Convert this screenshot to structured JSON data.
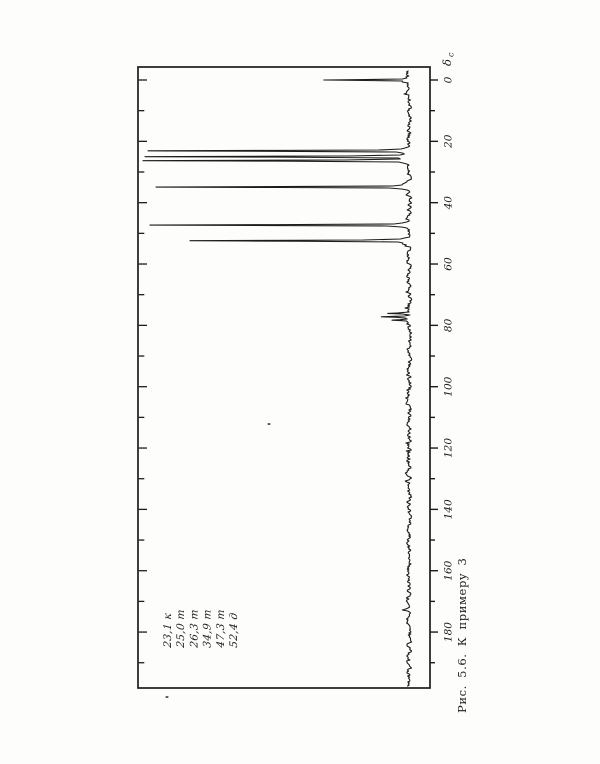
{
  "page": {
    "background": "#fdfdfc",
    "ink": "#1c1c1c"
  },
  "figure": {
    "caption": "Рис. 5.6.  К  примеру  3",
    "axis_title_delta": "δ",
    "axis_title_sub": "с"
  },
  "legend": {
    "items": [
      "23,1 к",
      "25,0 т",
      "26,3 т",
      "34,9 т",
      "47,3 т",
      "52,4 д"
    ]
  },
  "chart_data": {
    "type": "line",
    "orientation": "rotated-90 (delta axis runs top to bottom on the right edge, peaks point left)",
    "axis": {
      "label": "δс",
      "min": 0,
      "max": 195,
      "major_step": 20,
      "minor_step": 10,
      "tick_labels": [
        "0",
        "20",
        "40",
        "60",
        "80",
        "100",
        "120",
        "140",
        "160",
        "180"
      ]
    },
    "peaks": [
      {
        "shift": 0.0,
        "height_px": 80,
        "note": "reference"
      },
      {
        "shift": 23.1,
        "height_px": 248,
        "multiplicity": "к"
      },
      {
        "shift": 25.0,
        "height_px": 251,
        "multiplicity": "т"
      },
      {
        "shift": 26.3,
        "height_px": 253,
        "multiplicity": "т"
      },
      {
        "shift": 34.9,
        "height_px": 240,
        "multiplicity": "т"
      },
      {
        "shift": 47.3,
        "height_px": 246,
        "multiplicity": "т"
      },
      {
        "shift": 52.4,
        "height_px": 206,
        "multiplicity": "д"
      },
      {
        "shift": 76.1,
        "height_px": 20,
        "note": "small triplet"
      },
      {
        "shift": 77.2,
        "height_px": 26,
        "note": "small triplet"
      },
      {
        "shift": 78.3,
        "height_px": 16,
        "note": "small triplet"
      }
    ],
    "noise_amplitude_px": 2.1
  },
  "artifacts": {
    "specks": [
      {
        "x": 269,
        "y": 424
      },
      {
        "x": 167,
        "y": 697
      }
    ]
  }
}
